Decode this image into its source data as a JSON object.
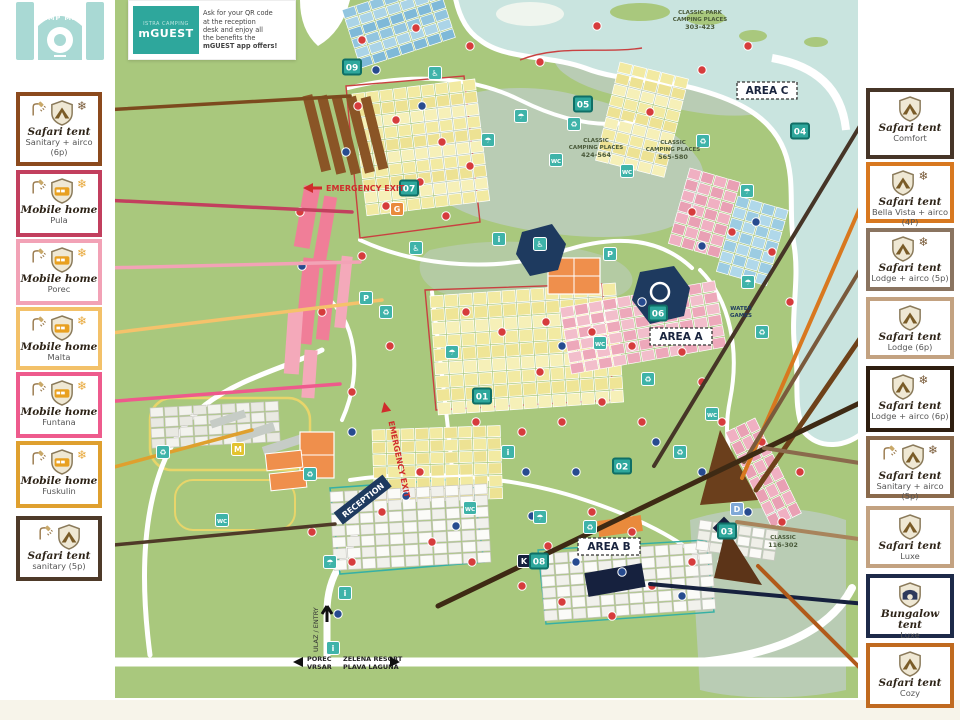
{
  "logo": {
    "title": "CAMP MAP"
  },
  "mguest": {
    "brand_small": "ISTRA CAMPING",
    "brand_big": "mGUEST",
    "lines": [
      "Ask for your QR code",
      "at the reception",
      "desk and enjoy all",
      "the benefits the",
      "mGUEST app offers!"
    ]
  },
  "legend": {
    "left": [
      {
        "title": "Safari tent",
        "subtitle": "Sanitary  + airco (6p)",
        "border": "#8C4A1D",
        "shield": "tent",
        "shower": true,
        "snow": true
      },
      {
        "title": "Mobile home",
        "subtitle": "Pula",
        "border": "#C23F5E",
        "shield": "mobile",
        "shower": true,
        "snow": true
      },
      {
        "title": "Mobile home",
        "subtitle": "Porec",
        "border": "#F2A2B6",
        "shield": "mobile",
        "shower": true,
        "snow": true
      },
      {
        "title": "Mobile home",
        "subtitle": "Malta",
        "border": "#F3C169",
        "shield": "mobile",
        "shower": true,
        "snow": true
      },
      {
        "title": "Mobile home",
        "subtitle": "Funtana",
        "border": "#EE5B8D",
        "shield": "mobile",
        "shower": true,
        "snow": true
      },
      {
        "title": "Mobile home",
        "subtitle": "Fuskulin",
        "border": "#DFA02F",
        "shield": "mobile",
        "shower": true,
        "snow": true
      },
      {
        "title": "Safari tent",
        "subtitle": "sanitary (5p)",
        "border": "#4E3A29",
        "shield": "tent",
        "shower": true,
        "snow": false
      }
    ],
    "right": [
      {
        "title": "Safari tent",
        "subtitle": "Comfort",
        "border": "#463527",
        "shield": "tent",
        "shower": false,
        "snow": false
      },
      {
        "title": "Safari tent",
        "subtitle": "Bella Vista + airco (4P)",
        "border": "#D8781F",
        "shield": "tent",
        "shower": false,
        "snow": true
      },
      {
        "title": "Safari tent",
        "subtitle": "Lodge + airco (5p)",
        "border": "#8A7460",
        "shield": "tent",
        "shower": false,
        "snow": true
      },
      {
        "title": "Safari tent",
        "subtitle": "Lodge (6p)",
        "border": "#C3A281",
        "shield": "tent",
        "shower": false,
        "snow": false
      },
      {
        "title": "Safari tent",
        "subtitle": "Lodge + airco (6p)",
        "border": "#2E1E10",
        "shield": "tent",
        "shower": false,
        "snow": true
      },
      {
        "title": "Safari tent",
        "subtitle": "Sanitary + airco (5p)",
        "border": "#8A6A4C",
        "shield": "tent",
        "shower": true,
        "snow": true
      },
      {
        "title": "Safari tent",
        "subtitle": "Luxe",
        "border": "#C3A281",
        "shield": "tent",
        "shower": false,
        "snow": false
      },
      {
        "title": "Bungalow tent",
        "subtitle": "Luxe",
        "border": "#1D2A49",
        "shield": "bungalow",
        "shower": false,
        "snow": false
      },
      {
        "title": "Safari tent",
        "subtitle": "Cozy",
        "border": "#C06A20",
        "shield": "tent",
        "shower": false,
        "snow": false
      }
    ]
  },
  "map": {
    "colors": {
      "land": "#A9C87D",
      "water": "#C9E4DF",
      "sage": "#B9CCB4",
      "accent_teal": "#2EA79C"
    },
    "area_a": "AREA A",
    "area_b": "AREA B",
    "area_c": "AREA C",
    "classic_park_1": "CLASSIC PARK",
    "classic_park_2": "CAMPING PLACES",
    "classic_park_3": "303-423",
    "classic1_1": "CLASSIC",
    "classic1_2": "CAMPING PLACES",
    "classic1_3": "424-564",
    "classic2_1": "CLASSIC",
    "classic2_2": "CAMPING PLACES",
    "classic2_3": "565-580",
    "water_games_1": "WATER",
    "water_games_2": "GAMES",
    "classic3_1": "CLASSIC",
    "classic3_2": "116-302",
    "emergency_exit": "EMERGENCY EXIT",
    "reception": "RECEPTION",
    "ulaz": "ULAZ / ENTRY",
    "porec_1": "POREC",
    "porec_2": "VRSAR",
    "zelena_1": "ZELENA RESORT",
    "zelena_2": "PLAVA LAGUNA",
    "numbered_badges": [
      {
        "n": "01",
        "x": 482,
        "y": 396
      },
      {
        "n": "02",
        "x": 622,
        "y": 466
      },
      {
        "n": "03",
        "x": 727,
        "y": 531
      },
      {
        "n": "04",
        "x": 800,
        "y": 131
      },
      {
        "n": "05",
        "x": 583,
        "y": 104
      },
      {
        "n": "06",
        "x": 658,
        "y": 313
      },
      {
        "n": "07",
        "x": 409,
        "y": 188
      },
      {
        "n": "08",
        "x": 539,
        "y": 561
      },
      {
        "n": "09",
        "x": 352,
        "y": 67
      }
    ],
    "letter_badges": [
      {
        "n": "G",
        "x": 397,
        "y": 209,
        "c": "#E98A3C"
      },
      {
        "n": "M",
        "x": 238,
        "y": 449,
        "c": "#E3C32F"
      },
      {
        "n": "D",
        "x": 737,
        "y": 509,
        "c": "#7FA8D8"
      },
      {
        "n": "K",
        "x": 524,
        "y": 561,
        "c": "#16213E"
      }
    ],
    "icon_badges": [
      {
        "g": "♿",
        "x": 435,
        "y": 73
      },
      {
        "g": "☂",
        "x": 521,
        "y": 116
      },
      {
        "g": "♻",
        "x": 574,
        "y": 124
      },
      {
        "g": "WC",
        "x": 627,
        "y": 171
      },
      {
        "g": "♻",
        "x": 703,
        "y": 141
      },
      {
        "g": "☂",
        "x": 747,
        "y": 191
      },
      {
        "g": "i",
        "x": 499,
        "y": 239
      },
      {
        "g": "♿",
        "x": 540,
        "y": 244
      },
      {
        "g": "P",
        "x": 610,
        "y": 254
      },
      {
        "g": "WC",
        "x": 600,
        "y": 343
      },
      {
        "g": "♻",
        "x": 648,
        "y": 379
      },
      {
        "g": "WC",
        "x": 712,
        "y": 414
      },
      {
        "g": "♻",
        "x": 386,
        "y": 312
      },
      {
        "g": "P",
        "x": 366,
        "y": 298
      },
      {
        "g": "♻",
        "x": 310,
        "y": 474
      },
      {
        "g": "☂",
        "x": 330,
        "y": 562
      },
      {
        "g": "i",
        "x": 345,
        "y": 593
      },
      {
        "g": "WC",
        "x": 470,
        "y": 508
      },
      {
        "g": "☂",
        "x": 540,
        "y": 517
      },
      {
        "g": "♻",
        "x": 590,
        "y": 527
      },
      {
        "g": "☂",
        "x": 748,
        "y": 282
      },
      {
        "g": "♻",
        "x": 762,
        "y": 332
      },
      {
        "g": "♿",
        "x": 416,
        "y": 248
      },
      {
        "g": "☂",
        "x": 452,
        "y": 352
      },
      {
        "g": "i",
        "x": 508,
        "y": 452
      },
      {
        "g": "♻",
        "x": 680,
        "y": 452
      },
      {
        "g": "WC",
        "x": 556,
        "y": 160
      },
      {
        "g": "☂",
        "x": 488,
        "y": 140
      },
      {
        "g": "♻",
        "x": 163,
        "y": 452
      },
      {
        "g": "WC",
        "x": 222,
        "y": 520
      },
      {
        "g": "i",
        "x": 333,
        "y": 648
      }
    ],
    "dots": {
      "red": [
        [
          362,
          40
        ],
        [
          416,
          28
        ],
        [
          470,
          46
        ],
        [
          597,
          26
        ],
        [
          540,
          62
        ],
        [
          650,
          112
        ],
        [
          702,
          70
        ],
        [
          748,
          46
        ],
        [
          358,
          106
        ],
        [
          396,
          120
        ],
        [
          442,
          142
        ],
        [
          470,
          166
        ],
        [
          420,
          182
        ],
        [
          386,
          206
        ],
        [
          446,
          216
        ],
        [
          300,
          212
        ],
        [
          362,
          256
        ],
        [
          322,
          312
        ],
        [
          390,
          346
        ],
        [
          352,
          392
        ],
        [
          466,
          312
        ],
        [
          502,
          332
        ],
        [
          546,
          322
        ],
        [
          592,
          332
        ],
        [
          632,
          346
        ],
        [
          540,
          372
        ],
        [
          476,
          422
        ],
        [
          522,
          432
        ],
        [
          562,
          422
        ],
        [
          602,
          402
        ],
        [
          642,
          422
        ],
        [
          682,
          352
        ],
        [
          702,
          382
        ],
        [
          722,
          422
        ],
        [
          762,
          442
        ],
        [
          790,
          302
        ],
        [
          772,
          252
        ],
        [
          732,
          232
        ],
        [
          692,
          212
        ],
        [
          420,
          472
        ],
        [
          382,
          512
        ],
        [
          432,
          542
        ],
        [
          472,
          562
        ],
        [
          522,
          586
        ],
        [
          562,
          602
        ],
        [
          612,
          616
        ],
        [
          652,
          586
        ],
        [
          692,
          562
        ],
        [
          592,
          512
        ],
        [
          632,
          532
        ],
        [
          548,
          546
        ],
        [
          352,
          562
        ],
        [
          312,
          532
        ],
        [
          800,
          472
        ],
        [
          782,
          522
        ]
      ],
      "blue": [
        [
          376,
          70
        ],
        [
          346,
          152
        ],
        [
          422,
          106
        ],
        [
          302,
          266
        ],
        [
          352,
          432
        ],
        [
          406,
          496
        ],
        [
          456,
          526
        ],
        [
          532,
          516
        ],
        [
          576,
          562
        ],
        [
          622,
          572
        ],
        [
          682,
          596
        ],
        [
          722,
          562
        ],
        [
          748,
          512
        ],
        [
          702,
          472
        ],
        [
          656,
          442
        ],
        [
          576,
          472
        ],
        [
          526,
          472
        ],
        [
          562,
          346
        ],
        [
          642,
          302
        ],
        [
          702,
          246
        ],
        [
          756,
          222
        ],
        [
          338,
          614
        ]
      ]
    },
    "leaders": {
      "left": [
        {
          "c": "#7C4A1E",
          "w": 3.5,
          "x1": 103,
          "y1": 110,
          "x2": 350,
          "y2": 96
        },
        {
          "c": "#C2405E",
          "w": 3.5,
          "x1": 103,
          "y1": 200,
          "x2": 352,
          "y2": 212
        },
        {
          "c": "#F2A3B6",
          "w": 3.5,
          "x1": 103,
          "y1": 268,
          "x2": 360,
          "y2": 262
        },
        {
          "c": "#F5C26B",
          "w": 3.5,
          "x1": 103,
          "y1": 334,
          "x2": 382,
          "y2": 300
        },
        {
          "c": "#EE5A8C",
          "w": 3.5,
          "x1": 103,
          "y1": 402,
          "x2": 340,
          "y2": 384
        },
        {
          "c": "#DFA02E",
          "w": 3.5,
          "x1": 103,
          "y1": 470,
          "x2": 252,
          "y2": 430
        },
        {
          "c": "#4F3A28",
          "w": 3.5,
          "x1": 103,
          "y1": 546,
          "x2": 335,
          "y2": 524
        }
      ],
      "right": [
        {
          "c": "#463527",
          "w": 4,
          "x1": 866,
          "y1": 116,
          "x2": 654,
          "y2": 466
        },
        {
          "c": "#D8781F",
          "w": 4,
          "x1": 866,
          "y1": 194,
          "x2": 742,
          "y2": 478
        },
        {
          "c": "#7A5A3C",
          "w": 4,
          "x1": 866,
          "y1": 260,
          "x2": 744,
          "y2": 462
        },
        {
          "c": "#6E4119",
          "w": 5,
          "x1": 866,
          "y1": 330,
          "x2": 756,
          "y2": 490
        },
        {
          "c": "#3E2A14",
          "w": 5,
          "x1": 866,
          "y1": 400,
          "x2": 438,
          "y2": 606
        },
        {
          "c": "#8A6A4C",
          "w": 4,
          "x1": 866,
          "y1": 464,
          "x2": 764,
          "y2": 448
        },
        {
          "c": "#A8845C",
          "w": 4,
          "x1": 866,
          "y1": 540,
          "x2": 737,
          "y2": 522
        },
        {
          "c": "#16213E",
          "w": 4,
          "x1": 866,
          "y1": 604,
          "x2": 650,
          "y2": 584
        },
        {
          "c": "#B15A1A",
          "w": 4,
          "x1": 866,
          "y1": 674,
          "x2": 758,
          "y2": 566
        }
      ]
    }
  }
}
